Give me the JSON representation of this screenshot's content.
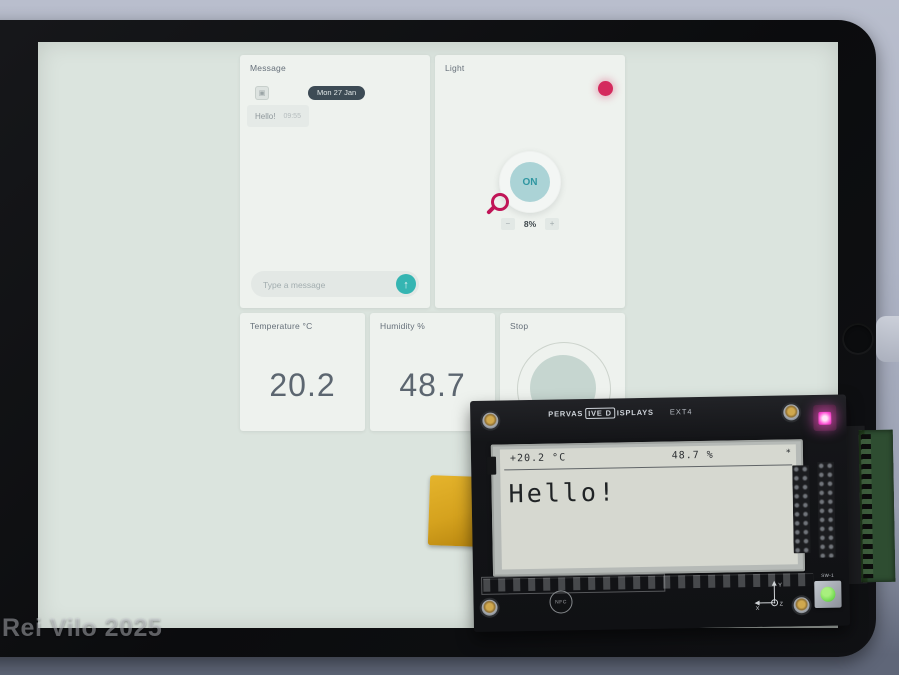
{
  "watermark": "Rei Vilo 2025",
  "colors": {
    "accent_teal": "#35b5b2",
    "led_red": "#d42a5d",
    "led_pink": "#ff54d6",
    "switch_green": "#6fd84f",
    "screen_bg": "#dbe4de"
  },
  "dashboard": {
    "message": {
      "title": "Message",
      "date_pill": "Mon 27 Jan",
      "bubble": {
        "text": "Hello!",
        "time": "09:55"
      },
      "input_placeholder": "Type a message",
      "send_glyph": "↑"
    },
    "light": {
      "title": "Light",
      "knob_label": "ON",
      "value": "8%",
      "step_minus": "−",
      "step_plus": "+"
    },
    "temperature": {
      "title": "Temperature °C",
      "value": "20.2"
    },
    "humidity": {
      "title": "Humidity %",
      "value": "48.7"
    },
    "stop": {
      "title": "Stop"
    }
  },
  "board": {
    "brand": {
      "left": "PERVAS",
      "boxed": "IVE D",
      "right": "ISPLAYS"
    },
    "model": "EXT4",
    "epd": {
      "temperature": "+20.2 °C",
      "humidity": "48.7 %",
      "flag": "*",
      "message": "Hello!"
    },
    "nfc_label": "NFC",
    "switch_label": "SW-1",
    "axis": {
      "x": "X",
      "y": "Y",
      "z": "Z"
    }
  }
}
